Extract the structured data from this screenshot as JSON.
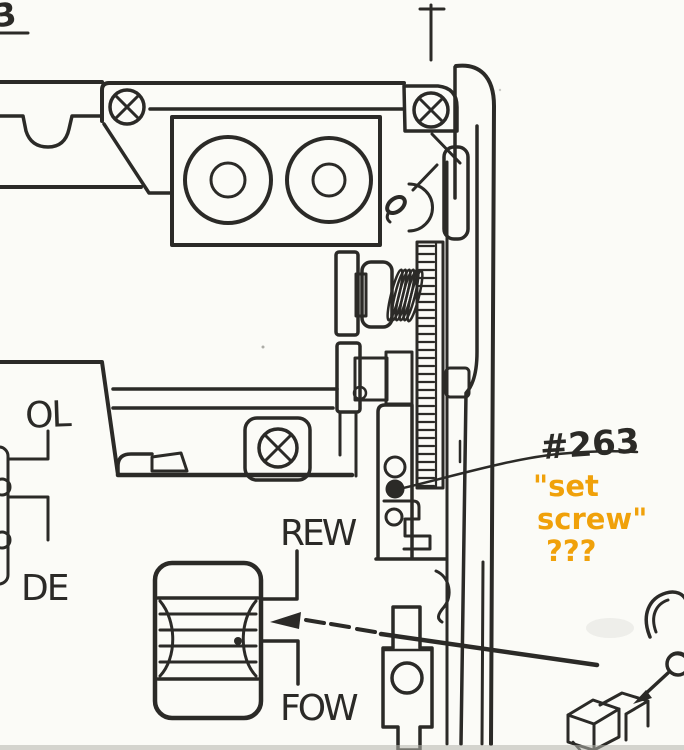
{
  "page": {
    "number": "3",
    "paper_color": "#fbfbf7",
    "ink_color": "#2b2a27",
    "scan_edge_color": "#b5b5ad"
  },
  "diagram": {
    "type": "scanned-service-manual-mechanism-drawing",
    "part_number_label": "#263",
    "labels": {
      "ol": "OL",
      "de": "DE",
      "rewind": "REW",
      "forward": "FOW"
    }
  },
  "annotation": {
    "color": "#f0a10a",
    "line1": "\"set",
    "line2": "screw\"",
    "line3": "???"
  }
}
